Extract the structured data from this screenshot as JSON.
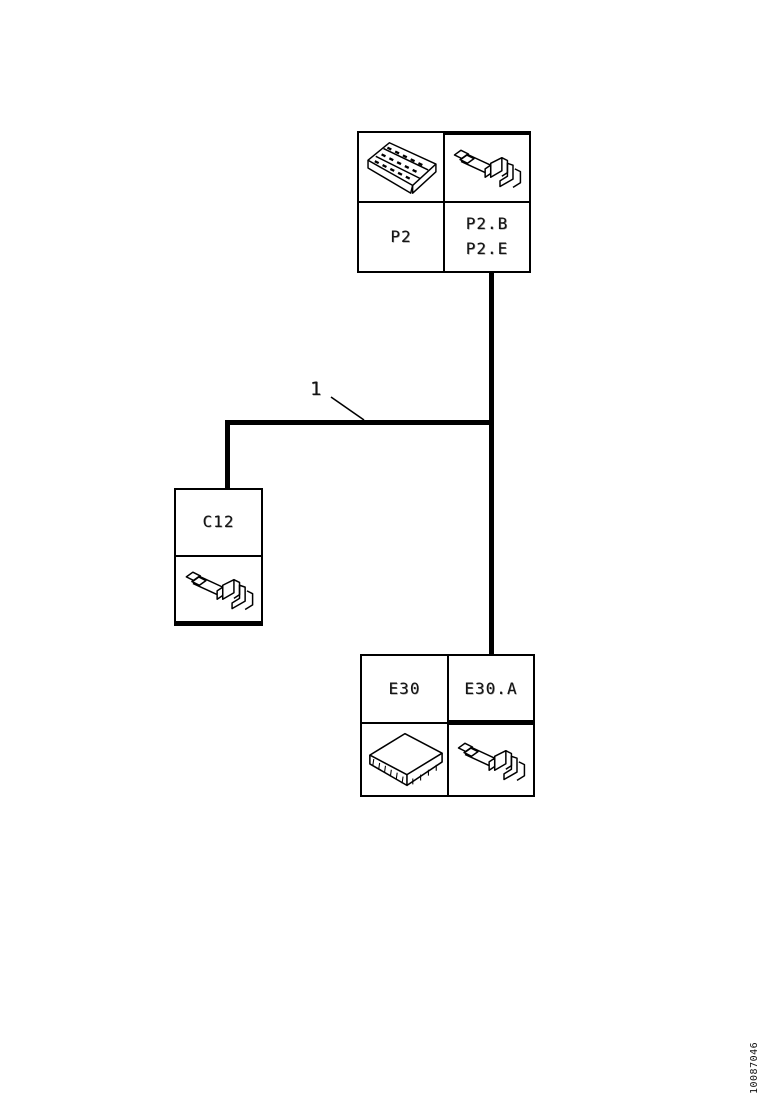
{
  "page": {
    "background": "#ffffff",
    "line_color": "#000000",
    "text_color": "#141414"
  },
  "components": {
    "p2": {
      "label": "P2",
      "terminal_labels": {
        "line1": "P2.B",
        "line2": "P2.E"
      },
      "images": {
        "connector": "multi-pin-connector-drawing",
        "terminal": "wire-terminal-drawing"
      }
    },
    "c12": {
      "label": "C12",
      "images": {
        "terminal": "wire-terminal-drawing"
      }
    },
    "e30": {
      "label": "E30",
      "terminal_label": "E30.A",
      "images": {
        "module": "control-module-drawing",
        "terminal": "wire-terminal-drawing"
      }
    }
  },
  "wires": {
    "harness_label": "1"
  },
  "footer": {
    "doc_number": "10087046"
  }
}
